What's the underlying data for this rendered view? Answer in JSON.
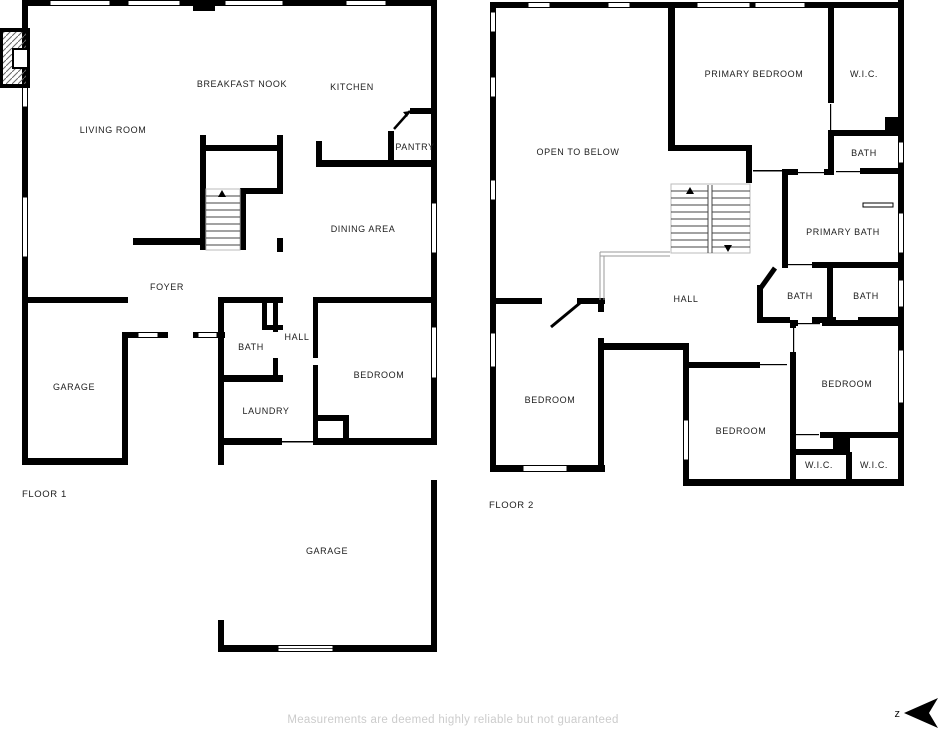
{
  "floor1": {
    "name_label": "FLOOR 1",
    "rooms": {
      "breakfast_nook": "BREAKFAST NOOK",
      "kitchen": "KITCHEN",
      "living_room": "LIVING ROOM",
      "pantry": "PANTRY",
      "dining_area": "DINING AREA",
      "foyer": "FOYER",
      "bath": "BATH",
      "hall": "HALL",
      "bedroom": "BEDROOM",
      "garage_left": "GARAGE",
      "laundry": "LAUNDRY",
      "garage_bottom": "GARAGE"
    }
  },
  "floor2": {
    "name_label": "FLOOR 2",
    "rooms": {
      "primary_bedroom": "PRIMARY BEDROOM",
      "wic_top": "W.I.C.",
      "open_to_below": "OPEN TO BELOW",
      "bath_top": "BATH",
      "primary_bath": "PRIMARY BATH",
      "hall": "HALL",
      "bath_left": "BATH",
      "bath_right": "BATH",
      "bedroom_left": "BEDROOM",
      "bedroom_middle": "BEDROOM",
      "bedroom_right": "BEDROOM",
      "wic_bottom_left": "W.I.C.",
      "wic_bottom_right": "W.I.C."
    }
  },
  "footer": {
    "disclaimer": "Measurements are deemed highly reliable but not guaranteed"
  },
  "compass": {
    "label": "z"
  },
  "colors": {
    "wall": "#000000",
    "label": "#1d1d1d",
    "disclaimer": "#cccccc",
    "railing": "#9a9a9a"
  }
}
